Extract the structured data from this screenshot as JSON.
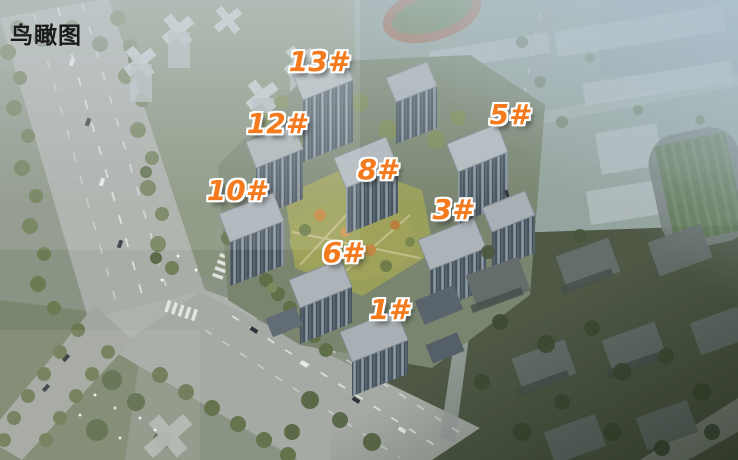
{
  "title": {
    "text": "鸟瞰图"
  },
  "colors": {
    "label_orange": "#f5791d",
    "label_outline": "#ffffff",
    "title_text": "#1c1c1c"
  },
  "buildings": [
    {
      "label": "13#"
    },
    {
      "label": "12#"
    },
    {
      "label": "10#"
    },
    {
      "label": "8#"
    },
    {
      "label": "5#"
    },
    {
      "label": "3#"
    },
    {
      "label": "6#"
    },
    {
      "label": "1#"
    }
  ]
}
